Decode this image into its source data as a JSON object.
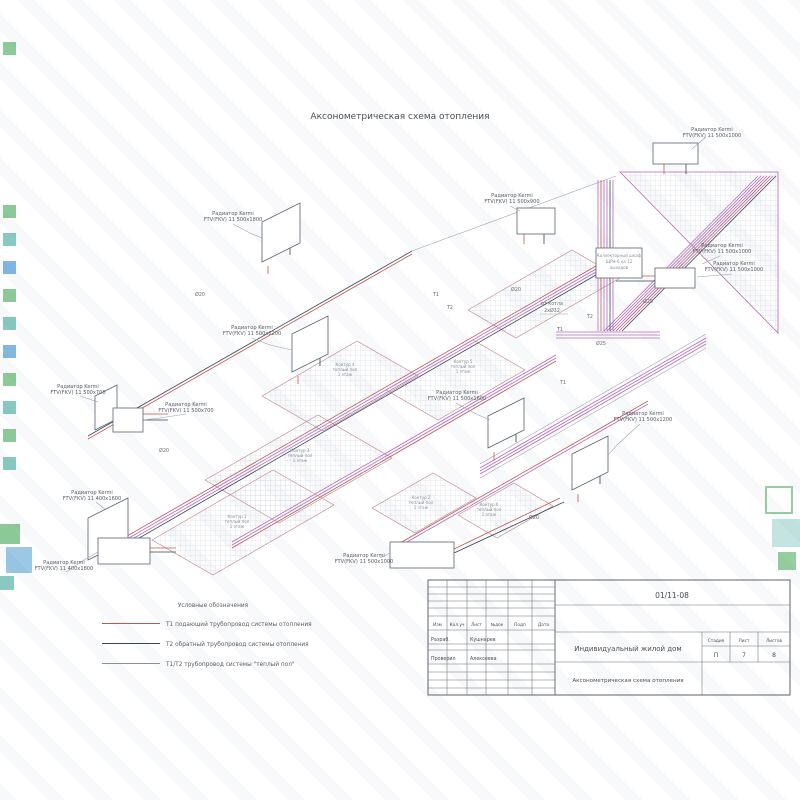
{
  "page": {
    "title": "Аксонометрическая схема отопления"
  },
  "drawing": {
    "radiator_name": "Радиатор Kermi",
    "radiators": [
      {
        "model": "FTV(FKV) 11 500x1000"
      },
      {
        "model": "FTV(FKV) 11 500x1800"
      },
      {
        "model": "FTV(FKV) 11 500x1200"
      },
      {
        "model": "FTV(FKV) 11 500x700"
      },
      {
        "model": "FTV(FKV) 11 500x700"
      },
      {
        "model": "FTV(FKV) 11 500x900"
      },
      {
        "model": "FTV(FKV) 11 500x1000"
      },
      {
        "model": "FTV(FKV) 11 500x1000"
      },
      {
        "model": "FTV(FKV) 11 500x1600"
      },
      {
        "model": "FTV(FKV) 11 500x1200"
      },
      {
        "model": "FTV(FKV) 11 400x1600"
      },
      {
        "model": "FTV(FKV) 11 400x1800"
      },
      {
        "model": "FTV(FKV) 11 500x1000"
      }
    ],
    "loop_sub": "теплый пол",
    "loop_floor": "1 этаж",
    "loops": [
      {
        "name": "Контур 4"
      },
      {
        "name": "Контур 5"
      },
      {
        "name": "Контур 3"
      },
      {
        "name": "Контур 1"
      },
      {
        "name": "Контур 2"
      },
      {
        "name": "Контур 6"
      }
    ],
    "collector": {
      "line1": "Коллекторный шкаф",
      "line2": "ЩРН-6 на 12",
      "line3": "выходов"
    },
    "ann": {
      "from_boiler": "от котла",
      "boiler_size": "2xØ32",
      "t1": "Т1",
      "t2": "Т2",
      "d20": "Ø20",
      "d25": "Ø25"
    }
  },
  "legend": {
    "title": "Условные обозначения",
    "items": [
      {
        "label": "Т1 подающий трубопровод системы отопления",
        "color": "#c0564f"
      },
      {
        "label": "Т2 обратный трубопровод системы отопления",
        "color": "#3a4556"
      },
      {
        "label": "Т1/Т2 трубопровод системы \"теплый пол\"",
        "color": "#8a8f98"
      }
    ]
  },
  "title_block": {
    "doc_number": "01/11-08",
    "headers": [
      "Изм",
      "Кол.уч",
      "Лист",
      "№док",
      "Подп",
      "Дата"
    ],
    "rows": [
      {
        "role": "Разраб.",
        "name": "Кушнарев"
      },
      {
        "role": "Проверил",
        "name": "Алексеева"
      }
    ],
    "project": "Индивидуальный жилой дом",
    "drawing_name": "Аксонометрическая схема отопления",
    "stage_label": "Стадия",
    "sheet_label": "Лист",
    "sheets_label": "Листов",
    "stage": "П",
    "sheet": "7",
    "sheets": "8"
  },
  "watermark": {
    "green": "#2f9e44",
    "teal": "#2a9d8f",
    "blue": "#1d7fc4"
  }
}
